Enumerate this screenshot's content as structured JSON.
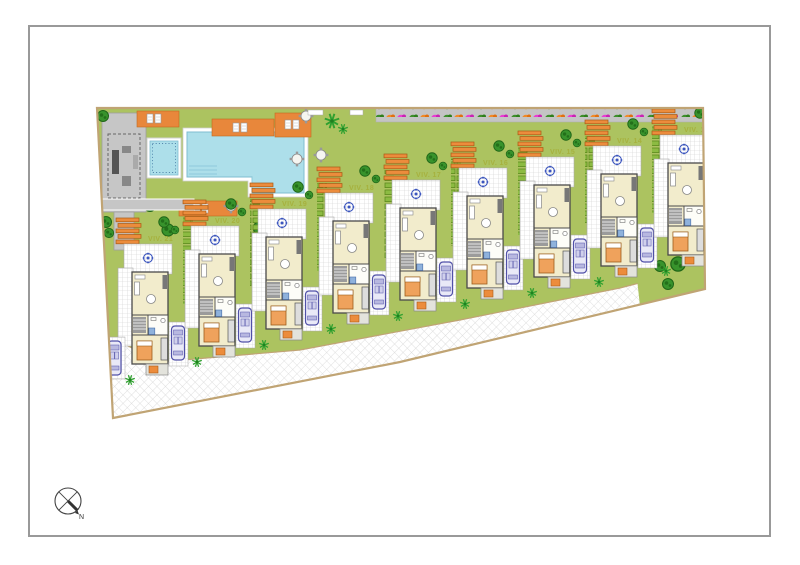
{
  "plan": {
    "villas": [
      {
        "label": "VIV. 21"
      },
      {
        "label": "VIV. 20"
      },
      {
        "label": "VIV. 19"
      },
      {
        "label": "VIV. 18"
      },
      {
        "label": "VIV. 17"
      },
      {
        "label": "VIV. 16"
      },
      {
        "label": "VIV. 15"
      },
      {
        "label": "VIV. 14"
      },
      {
        "label": "VIV. 13"
      }
    ],
    "compass": {
      "north_label": "N"
    },
    "colors": {
      "lawn": "#acc360",
      "pool_water": "#addfea",
      "boundary": "#c0a474",
      "paving_gray": "#c6c6c6",
      "road_hatch": "#dadada",
      "lounger_orange": "#ec8c3c",
      "flower_orange": "#f08a28",
      "flower_magenta": "#e93ed2",
      "hedge_green": "#8cbb42",
      "tree_green": "#38932c",
      "building_cream": "#f2eccc",
      "wall_gray": "#4a4a4a",
      "car_blue": "#5050a8",
      "label_green": "#a6b13e"
    }
  }
}
